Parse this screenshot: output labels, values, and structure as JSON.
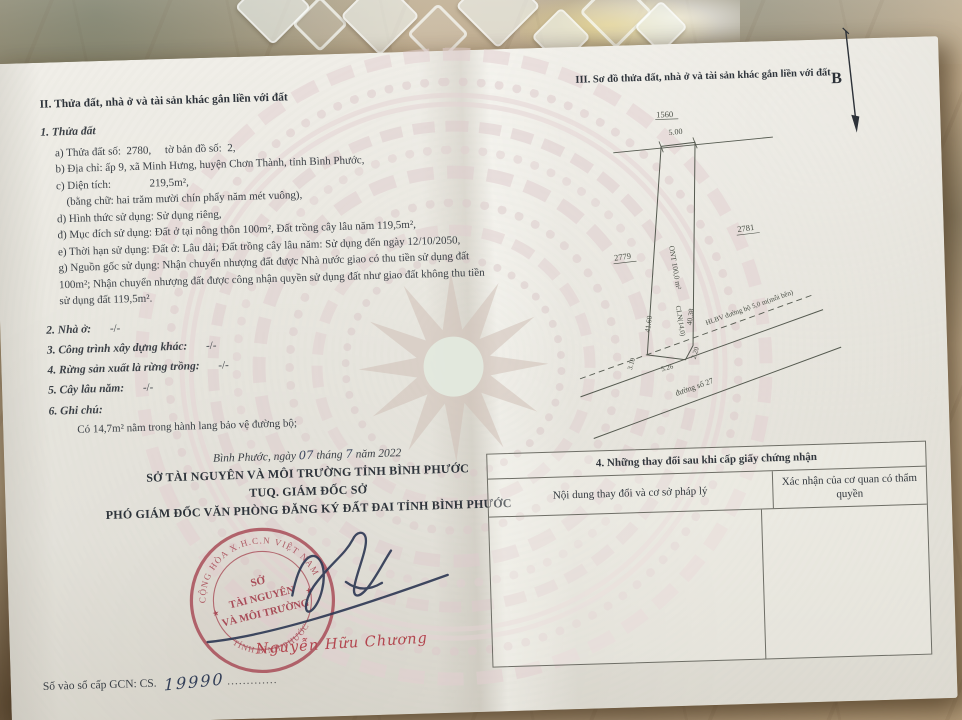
{
  "colors": {
    "stamp_red": "#a4414e",
    "signature_ink": "#2f3a55",
    "watermark_pink": "#dfcacd",
    "paper": "#eae8e1"
  },
  "certificate": {
    "section_ii": {
      "heading": "II. Thửa đất, nhà ở và tài sản khác gắn liền với đất",
      "sub_heading": "1. Thửa đất",
      "detail_lines": [
        "a) Thửa đất số:  2780,     tờ bản đồ số:  2,",
        "b) Địa chỉ: ấp 9, xã Minh Hưng, huyện Chơn Thành, tỉnh Bình Phước,",
        "c) Diện tích:              219,5m²,",
        "(bằng chữ: hai trăm mười chín phẩy năm mét vuông),",
        "d) Hình thức sử dụng: Sử dụng riêng,",
        "đ) Mục đích sử dụng: Đất ở tại nông thôn 100m², Đất trồng cây lâu năm 119,5m²,",
        "e) Thời hạn sử dụng: Đất ở: Lâu dài; Đất trồng cây lâu năm: Sử dụng đến ngày 12/10/2050,",
        "g) Nguồn gốc sử dụng: Nhận chuyển nhượng đất được Nhà nước giao có thu tiền sử dụng đất 100m²; Nhận chuyển nhượng đất được công nhận quyền sử dụng đất như giao đất không thu tiền sử dụng đất 119,5m²."
      ],
      "numbered_items": [
        {
          "label": "2. Nhà ở:",
          "value": "-/-"
        },
        {
          "label": "3. Công trình xây dựng khác:",
          "value": "-/-"
        },
        {
          "label": "4. Rừng sản xuất là rừng trồng:",
          "value": "-/-"
        },
        {
          "label": "5. Cây lâu năm:",
          "value": "-/-"
        },
        {
          "label": "6. Ghi chú:",
          "value": ""
        }
      ],
      "note": "Có 14,7m² nằm trong hành lang bảo vệ đường bộ;"
    },
    "issuance": {
      "date_prefix": "Bình Phước, ngày",
      "date_day": "07",
      "date_mid": "tháng",
      "date_month": "7",
      "date_suffix": "năm 2022",
      "authority_line1": "SỞ TÀI NGUYÊN VÀ MÔI TRƯỜNG TỈNH BÌNH PHƯỚC",
      "authority_line2": "TUQ. GIÁM ĐỐC SỞ",
      "authority_line3": "PHÓ GIÁM ĐỐC VĂN PHÒNG ĐĂNG KÝ ĐẤT ĐAI TỈNH BÌNH PHƯỚC",
      "signer_name": "Nguyễn Hữu Chương",
      "stamp": {
        "arc_top": "CỘNG HÒA X.H.C.N VIỆT NAM",
        "line1": "SỞ",
        "line2": "TÀI NGUYÊN",
        "line3": "VÀ MÔI TRƯỜNG",
        "arc_bottom": "TỈNH BÌNH PHƯỚC",
        "star": "★"
      },
      "serial_label": "Số vào sổ cấp GCN: CS.",
      "serial_number": "19990",
      "serial_dots": "............."
    },
    "section_iii": {
      "heading": "III. Sơ đồ thửa đất, nhà ở và tài sản khác gắn liền với đất",
      "north_label": "B",
      "map": {
        "parcel_number_top": "1560",
        "neighbor_left": "2779",
        "neighbor_right": "2781",
        "dim_top": "5.00",
        "dim_left": "41.60",
        "dim_right": "40.38",
        "parcel_label": "ONT 100,0 m²",
        "parcel_sublabel": "CLN(14,0)",
        "corridor_label": "HLBV đường bộ 5,0 m(mỗi bên)",
        "road_label": "đường số 27",
        "dim_bevel_left": "3.10",
        "dim_bottom": "5.26",
        "dim_bevel_right": "2.20"
      },
      "table4": {
        "title": "4. Những thay đổi sau khi cấp giấy chứng nhận",
        "col_content": "Nội dung thay đổi và cơ sở pháp lý",
        "col_confirm": "Xác nhận của cơ quan có thẩm quyền"
      }
    }
  }
}
